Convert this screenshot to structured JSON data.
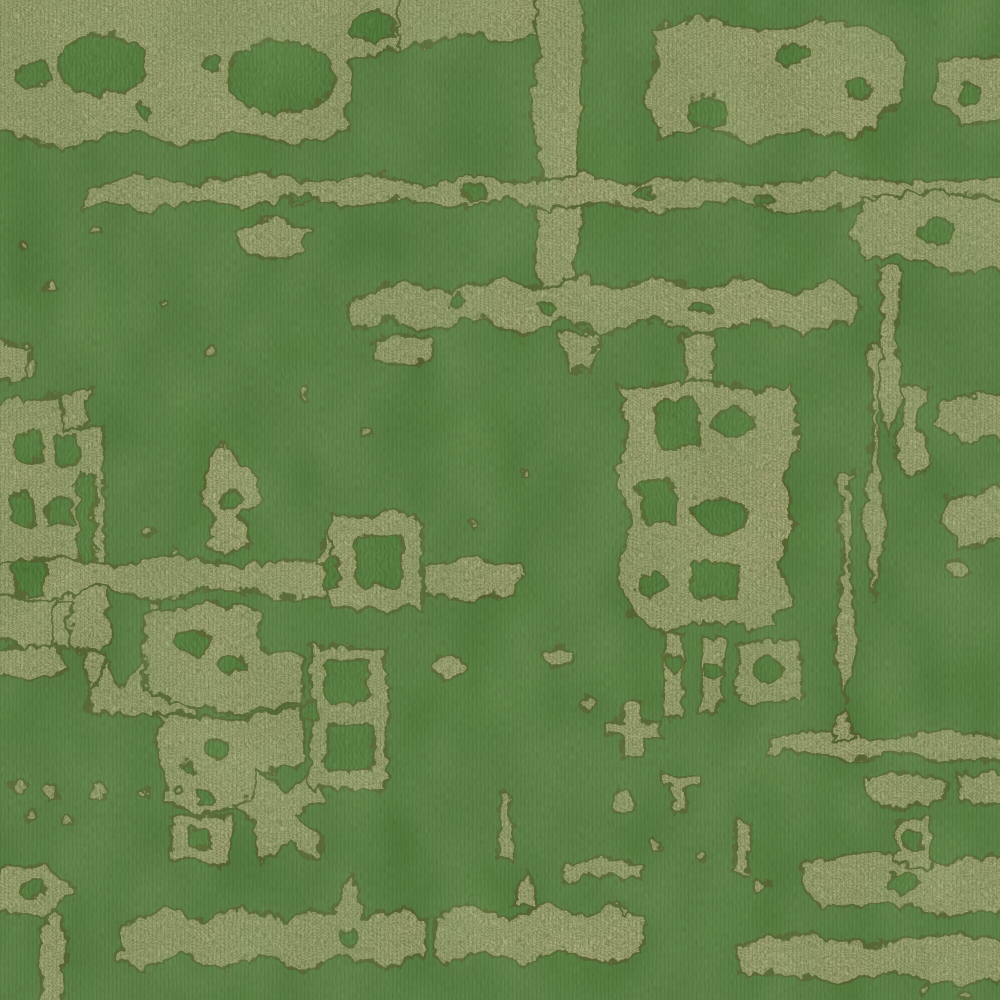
{
  "meta": {
    "subject": "fabric-swatch",
    "alt_text": "Close-up of green chenille velvet upholstery fabric with an abstract distressed grid pattern woven in antique gold threads"
  },
  "palette": {
    "green_base": "#4e7c3a",
    "green_dark": "#3a6129",
    "green_light": "#66914c",
    "tan_base": "#b3aa7c",
    "tan_light": "#cfc69c",
    "tan_dark": "#8f885a",
    "outline_dark": "#565b2c",
    "thread_highlight": "#e9e5c8"
  }
}
